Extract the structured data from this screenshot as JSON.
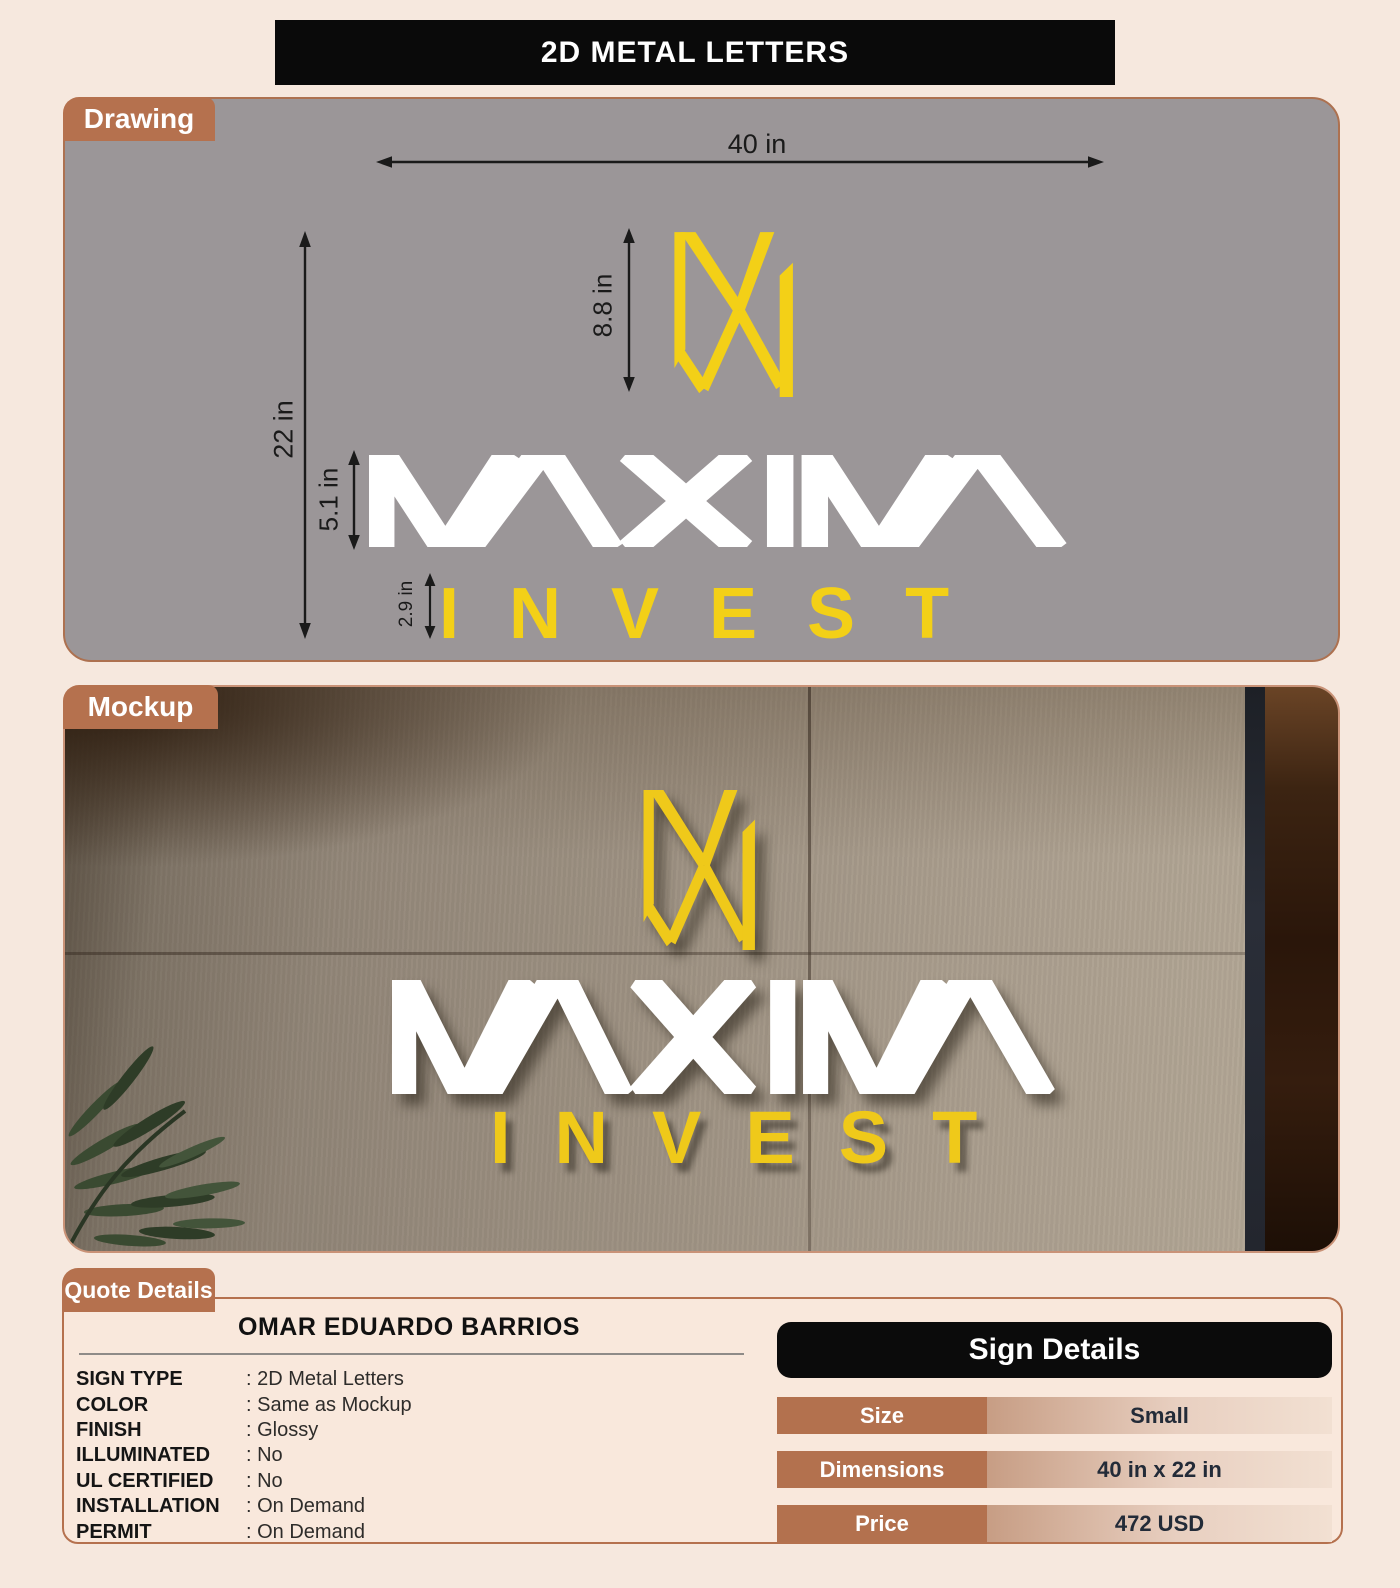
{
  "banner": {
    "title": "2D METAL LETTERS"
  },
  "drawing": {
    "tab_label": "Drawing",
    "dimensions": {
      "overall_width": "40 in",
      "overall_height": "22 in",
      "icon_height": "8.8 in",
      "wordmark_height": "5.1 in",
      "subtext_height": "2.9 in"
    }
  },
  "logo": {
    "wordmark": "MAXIMA",
    "subtext": "INVEST",
    "accent_yellow": "#f3d017",
    "wordmark_color": "#ffffff"
  },
  "mockup": {
    "tab_label": "Mockup"
  },
  "quote": {
    "tab_label": "Quote Details",
    "customer_name": "OMAR EDUARDO BARRIOS",
    "specs": [
      {
        "label": "SIGN TYPE",
        "value": ": 2D Metal Letters"
      },
      {
        "label": "COLOR",
        "value": ": Same as Mockup"
      },
      {
        "label": "FINISH",
        "value": ": Glossy"
      },
      {
        "label": "ILLUMINATED",
        "value": ": No"
      },
      {
        "label": "UL CERTIFIED",
        "value": ": No"
      },
      {
        "label": "INSTALLATION",
        "value": ": On Demand"
      },
      {
        "label": "PERMIT",
        "value": ": On Demand"
      }
    ],
    "sign_details": {
      "title": "Sign Details",
      "rows": [
        {
          "label": "Size",
          "value": "Small"
        },
        {
          "label": "Dimensions",
          "value": "40 in x 22 in"
        },
        {
          "label": "Price",
          "value": "472 USD"
        }
      ]
    }
  },
  "colors": {
    "page_bg": "#f6e8de",
    "tab_brown": "#b5714e",
    "drawing_panel_gray": "#9b9698",
    "banner_black": "#0a0a0a",
    "table_cell_brown": "#b3714e"
  }
}
